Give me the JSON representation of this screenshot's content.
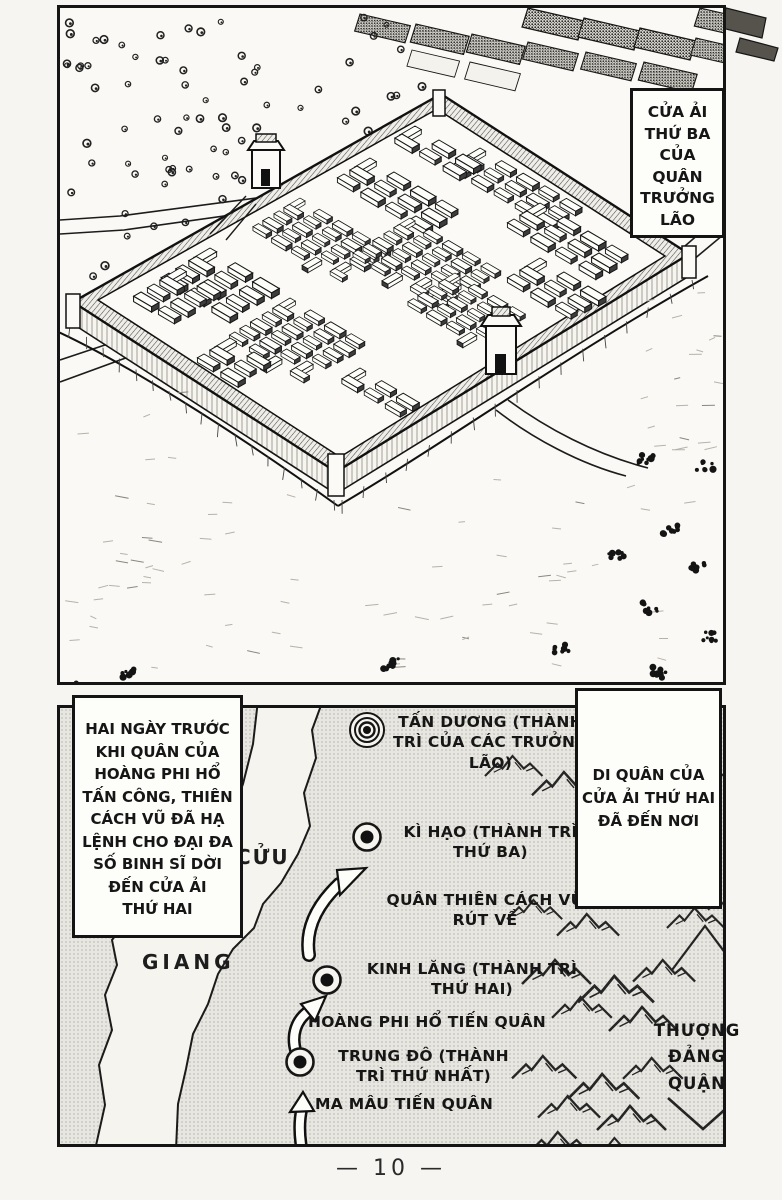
{
  "page": {
    "number": "— 10 —"
  },
  "panel1": {
    "caption": "CỬA ẢI\nTHỨ BA\nCỦA\nQUÂN\nTRƯỞNG\nLÃO"
  },
  "panel2": {
    "narration_left": "HAI NGÀY TRƯỚC\nKHI QUÂN CỦA\nHOÀNG PHI HỔ\nTẤN CÔNG, THIÊN\nCÁCH VŨ ĐÃ HẠ\nLỆNH CHO ĐẠI ĐA\nSỐ BINH SĨ DỜI\nĐẾN CỬA ẢI\nTHỨ HAI",
    "narration_right": "DI QUÂN CỦA\nCỬA ẢI THỨ HAI\nĐÃ ĐẾN NƠI",
    "river": {
      "name_line1": "CỬU",
      "name_line2": "GIANG"
    },
    "locations": [
      {
        "name": "TẤN DƯƠNG",
        "marker": "triple-ring",
        "label": "TẤN DƯƠNG (THÀNH\nTRÌ CỦA CÁC TRƯỞNG\nLÃO)"
      },
      {
        "name": "KÌ HẠO",
        "marker": "ring-dot",
        "label": "KÌ HẠO (THÀNH TRÌ\nTHỨ BA)"
      },
      {
        "name": "KINH LĂNG",
        "marker": "ring-dot",
        "label": "KINH LĂNG (THÀNH TRÌ\nTHỨ HAI)"
      },
      {
        "name": "TRUNG ĐÔ",
        "marker": "ring-dot",
        "label": "TRUNG ĐÔ (THÀNH\nTRÌ THỨ NHẤT)"
      }
    ],
    "movements": [
      {
        "label": "QUÂN THIÊN CÁCH VŨ\nRÚT VỀ"
      },
      {
        "label": "HOÀNG PHI HỔ TIẾN QUÂN"
      },
      {
        "label": "MA MÂU TIẾN QUÂN"
      }
    ],
    "region": "THƯỢNG\nĐẢNG\nQUẬN"
  },
  "colors": {
    "ink": "#161616",
    "map_bg": "#e8e6e1",
    "paper": "#f6f5f1"
  }
}
